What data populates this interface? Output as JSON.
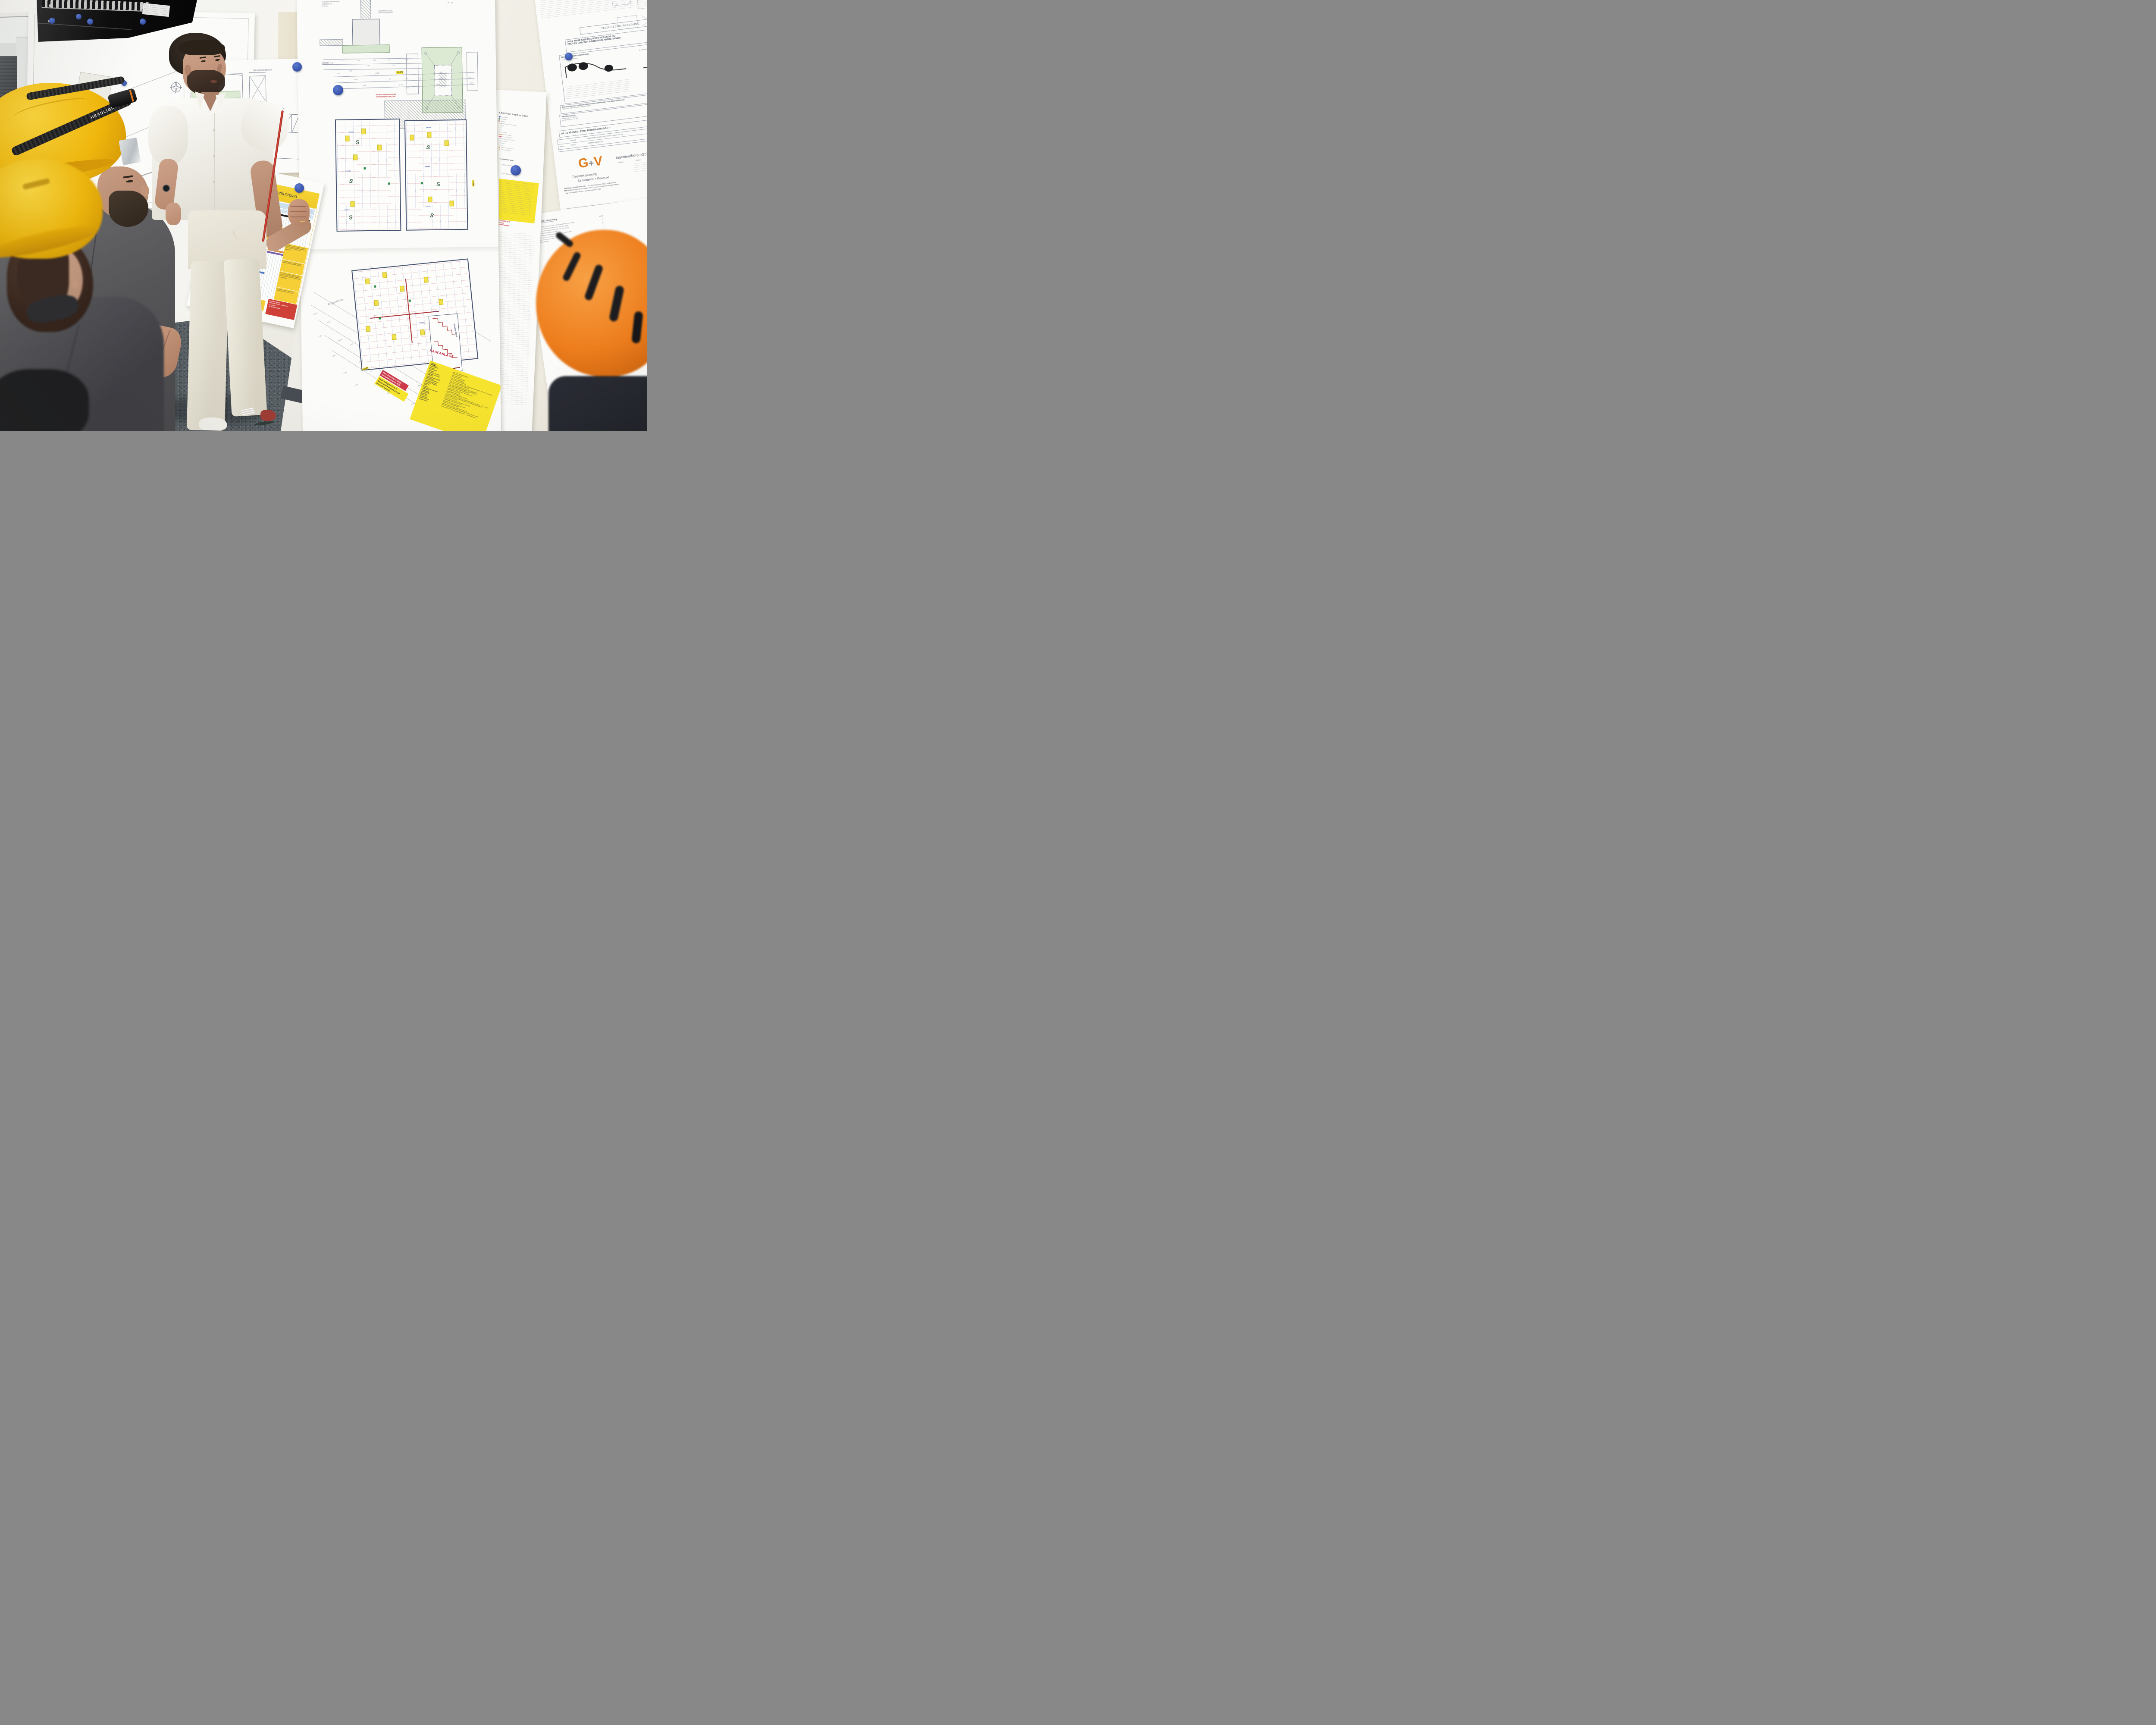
{
  "scene_description": "Construction team briefing in front of wall of pinned technical drawings",
  "people": {
    "left_helmet_strap_text": "HEADLIGHT"
  },
  "sheets": {
    "bridge": {
      "caption": "SCHNITT CONTAINERHALLE · BRÜCKE · BESTAND",
      "detail": "Querschnitt Brücke",
      "slope": "Dachneigung 2%"
    },
    "safety": {
      "title": "Sicherheits- und Gesundheitsschutzplan",
      "orange_note": [
        "Temporäre Abdeckungen:",
        "Öffnungen sind sofort nach der",
        "Erzeugung gegen Ein- oder",
        "Durchtreten zu sichern"
      ],
      "boxes": [
        "Vor Aufnahme der Tätigkeit erfolgt eine Erstunterweisung der Mitarbeiter durch die jeweiligen Führungskräfte (Bauleiter)",
        "Nur unterwiesenes und autorisiertes Personal darf die Baustelle betreten!",
        "Flucht- und Rettungswege sind immer zu gewährleisten; ggf. ist ein Änderung vor Ort abzustimmen und entsprechend zu beschildern!",
        "Der Bauzaun bzw. Baubereich ist jederzeit geschlossen zu halten"
      ],
      "red_notice": [
        "Unfälle / Notfälle",
        "sind dem SiGeKo umgehend",
        "zu melden!",
        "Tel. 0170 932 8006"
      ]
    },
    "center": {
      "found_titles": [
        "KÖCHERFUNDAMENT",
        "SCHALPLAN",
        "M. 1:25"
      ],
      "wall_note": [
        "KÖCHERWANDUNG",
        "GLATTE SCHALUNG"
      ],
      "scale_note": "M 1:25",
      "schnitt_label": "SCHNITT 1 - 1",
      "found_dims": [
        "1.18",
        "40",
        "1.10",
        "40",
        "1.18",
        "1.90",
        "4.20",
        "2.10"
      ],
      "access_note": [
        "ZUGANG OBERGESCHOSS",
        "SONDERKONSTRUKTION"
      ],
      "dim_highlight": "15.470",
      "dims_top": [
        "160",
        "15.150",
        "160",
        "6.060",
        "15",
        "2.000",
        "15",
        "6.060",
        "160",
        "6.465",
        "2.220",
        "2.800",
        "6.465",
        "1.39"
      ],
      "room_ids": [
        "3002419",
        "3002418",
        "3002417",
        "3002425",
        "3002426",
        "3002423"
      ],
      "dim_right": "10.684",
      "erdgeschoss_label": "Erdgeschoss",
      "stairs_note": "4 Stufen 29/15",
      "existing_note": "Bestandsgebäude",
      "dim_highlight2": "23.075",
      "dims_left": [
        "-23.075",
        "6.195",
        "6.060",
        "-20.045",
        "2.200",
        "2.350",
        "-17.007",
        "2.440",
        "15",
        "3.660",
        "-14.552",
        "3.000",
        "-11.537",
        "-8.522",
        "-6.067",
        "-3.030"
      ],
      "stair_ids": [
        "3001950",
        "3001951"
      ]
    },
    "legend": {
      "title": "LEGENDE ANSCHLÜSSE",
      "items": [
        {
          "shape": "circle",
          "color": "#2f56b0",
          "label": "Regenwasser"
        },
        {
          "shape": "diamond",
          "color": "#3d7a36",
          "label": "Trinkwasser"
        },
        {
          "shape": "diamond",
          "color": "#8a2f2f",
          "label": "Abwasser"
        },
        {
          "shape": "diamond",
          "color": "#d9a32a",
          "label": "Fäkalienhaltiges Schmutzwasser"
        },
        {
          "shape": "diamond",
          "color": "#c04a7a",
          "label": "Heizung"
        },
        {
          "shape": "square",
          "color": "#d97f2a",
          "label": "Gas"
        },
        {
          "shape": "square",
          "color": "#cc3127",
          "label": "Strom"
        },
        {
          "shape": "square",
          "color": "#f0d32f",
          "label": "Daten, Toiletten"
        },
        {
          "shape": "line",
          "color": "#e08a3c",
          "label": "Leerrohr Elektro"
        },
        {
          "shape": "line",
          "color": "#d84f8e",
          "label": "Leerrohre Heizung"
        },
        {
          "shape": "square",
          "color": "#aab4c0",
          "label": "Bodendurchbruch / Bodenablauf"
        },
        {
          "shape": "diamond",
          "color": "#7a9ac4",
          "label": "Deckendurchbruch"
        },
        {
          "shape": "circle",
          "color": "#9a6a5a",
          "label": "Schutzleitung"
        },
        {
          "shape": "circle",
          "color": "#a8a8a8",
          "label": "Tiefenerder"
        },
        {
          "shape": "bar",
          "color": "#e0a060",
          "label": "Ringerder V4A 30x3,5 mm"
        },
        {
          "shape": "bar",
          "color": "#e8c090",
          "label": "Graben für Ringerder"
        }
      ],
      "title2": "LEGENDE Fundamente Ideen",
      "fund_items": [
        {
          "color": "#f2d12e",
          "label": "1000x1000x200mm"
        },
        {
          "color": "#d33a2f",
          "label": "1200x1200x250mm"
        }
      ],
      "note_red": [
        "NEUE PROJEKTGRUNDLAGE",
        "Bodenbelag Variante 3",
        "komplett auf Baustelle gelegt!"
      ]
    },
    "titleblock": {
      "technical_change": "TECHNISCHE ÄNDERUNG",
      "mass_note": [
        "ALLE MAßE SIND BAUSEITS VERANTW. ZU",
        "PRÜFEN UND VOR BAUBEGINN ABZUSTIMMEN"
      ],
      "bend_title": "Biegen von Betonstahlmatten",
      "bend_a": "A) Biegungen zur Kröpfung",
      "bend_b": "B) einfache Biegungen",
      "classes_row": "Betonfestigkeits- und Expositionsklassen; Betonstahl- und Spannstahlsorte:",
      "classes_detail": "C25/30 WF, XC2, XF1 bzw. FUNDAMENTBAU",
      "cover_row": "Betondeckung:",
      "cover_details": [
        "Verlegemaß: cv = 35 mm",
        "Vorhaltemaß: Δc = 15 mm"
      ],
      "rohbau_note": "ALLE MASSE SIND ROHBAUMASSE !",
      "index_row": [
        "'A'",
        "24.08.25",
        "ÄNDERUNGEN NACH PRÜFSTATIK (zusätzl. Pos. 14)"
      ],
      "index_header": [
        "INDEX",
        "DATUM",
        "ART DER ÄNDERUNG"
      ],
      "logo": {
        "g": "G",
        "plus": "+",
        "v": "V",
        "firm": "Ingenieurbüro eGbR",
        "partner1": "Vielgut",
        "partner2": "Vielgut",
        "tagline1": "Tragwerksplanung",
        "tagline2": "für Industrie + Gewerbe"
      },
      "fields": [
        {
          "label": "AUFTRAG- GEBER",
          "value": "GMB GbR — Am Tannenberg 29 · 96132 Schlüsselfeld"
        },
        {
          "label": "PROJEKT:",
          "value": "Zukunftsvision Embeka / KB Container — Standort Langenlonsheim"
        },
        {
          "label": "TEIL:",
          "value": "FUNDAMENTPLAN — Köcherfundament -F1.1"
        },
        {
          "label": "ZEICHNUNGSNUMMER:",
          "value": "24649 - FU 1.5A"
        },
        {
          "label": "MASSTAB:",
          "value": "1 : 25"
        }
      ],
      "sig": [
        {
          "label": "GEZEICHNET:",
          "name": "TAUSCH",
          "date": "18.08.2025"
        },
        {
          "label": "GEÄNDERT:",
          "name": "TAUSCH",
          "date": "24.08.2025"
        },
        {
          "label": "GEÄNDERT:",
          "name": "",
          "date": ""
        }
      ],
      "footer": "G+V 24649"
    },
    "kauf": {
      "title": "KAUFANLAGE",
      "subtitle": "Farben:",
      "rows": [
        {
          "l": "Container:",
          "v": "RAL 7016  Rahmen&Panele"
        },
        {
          "l": "Sockelblende:",
          "v": "RAL 7016  außen"
        },
        {
          "l": "Fenster:",
          "v": "RAL 7016  innen"
        },
        {
          "l": "Fenster TPH:",
          "v": "RAL 9016  innen&außen"
        },
        {
          "l": "Alutüren:",
          "v": "RAL 7016  innen&außen"
        },
        {
          "l": "Türzargen Innentür:",
          "v": "Eiche, lasiert weiß (Klassen)"
        },
        {
          "l": "Türblätter Innentüren:",
          "v": "RAL 1016 Schwefelgelb / RAL 9006 Silbermetallic / RAL 9010 weiß (zwischen Klassen, Team zu Technik)"
        },
        {
          "l": "Raffstore:",
          "v": "Jeldwen Duritop Uni weiß beidseitig"
        },
        {
          "l": "Innwand Gipswand Q3:",
          "v": "RAL 1016 Schwefelgelb flurseitig + raumseitig weiß"
        },
        {
          "l": "Wandfliesen:",
          "v": "RAL 9006 Silbermetallic flurseitig + raumseitig weiß"
        },
        {
          "l": "Akustikabhangdecke:",
          "v": "Eiche, lasiert weiß beidseitig (Klassen)"
        },
        {
          "l": "Sanitärtrennwände:",
          "v": "Lamellen RAL 7016, 60 mm / Weiß RAL 9010"
        },
        {
          "l": "Beschläge/ Standard",
          "v": "Silbermetallic RAL 9006"
        },
        {
          "l": "Zubehör:",
          "v": "Schwefelgelb RAL 1016"
        },
        {
          "l": "Dach:",
          "v": "Kermos Concept Plato, weiß, 10x10 cm"
        },
        {
          "l": "Vordach:",
          "v": "Knauf HERADESIGN Superfine, Beige (Plattengröße 60x120cm - GK, verschraubt im halbversatz)"
        },
        {
          "l": "Dämmung Sekundärdach:",
          "v": "CTH 13-2 HPL 0085 FH Weiß, H:2000 mm, mit Fingerklemmschutz"
        },
        {
          "l": "Attikablech",
          "v": "ECO 07 (ca. RAL 1021)"
        },
        {
          "l": "Bodenbelag:",
          "v": "Trapezblech RAL 9002 / Trapezblech RAL 7016"
        },
        {
          "l": "Linoleum R9:",
          "v": "Mineralwolle 100mm / RAL 7016"
        },
        {
          "l": "Nadelvlies:",
          "v": "marmoleum cocoa, 3584 white chocolate"
        },
        {
          "l": "Fliesen R10:",
          "v": "Nadelvlies Forbo 96003 sand"
        },
        {
          "l": "Sockelleiste:",
          "v": "vilbostoneplus 10x10cm, anthrazit: PN83, R10"
        },
        {
          "l": "Sauberlaufzone:",
          "v": "bei Lino Hochzug Bodenbelag, Sockelleiste, Vollholz, Buche - weiß"
        },
        {
          "l": "Treppenstufen:",
          "v": "2,00x1,80m, 080 Sand, Gorips / Nadelvlies - Euval 93.00 Bono"
        }
      ]
    },
    "announce": {
      "red": [
        "Neue Projektgrundlage",
        "Containervariante 2025"
      ],
      "yellow": [
        "Bodenbelagsvariante 3",
        "Boden wird komplett auf der",
        "Baustelle verlegt!"
      ]
    },
    "elt": {
      "title": "L 03 Legende-ELT Beleuchtung",
      "col1": "Element ID",
      "col2": "Menge",
      "rows": [
        {
          "t": "Tafelbeleuchtung TRILUX, Atrion D-L RAV 1500 4900-840 ET, 38W (TOC 77x1240)",
          "q": "12"
        },
        {
          "t": "TRILUX, Atrion D-L RPV 1200 3300-840-ET, 31W, LED, TOC 6492840",
          "q": "22"
        },
        {
          "t": "TRILUX, Atrion D-L RPV 1500 3200-840 ET, 52W, LED, TOC 6634640",
          "q": "50"
        },
        {
          "t": "LEDVANCE FLOODLIGHT SENSOR 50 41W",
          "q": "2"
        },
        {
          "t": "Feuchtraumwannenleuchte Adolf Schuch GmbH 167  G2_LED 43W 5200lm",
          "q": "4"
        },
        {
          "t": "Präsenzmelder ESYLUX Basic Einbau",
          "q": ""
        },
        {
          "t": "Präsenzmelder ESYLUX Basic Aufputz",
          "q": ""
        },
        {
          "t": "Präsenzmelder HF-Melder",
          "q": ""
        }
      ],
      "kb_logo": "KB",
      "kb_sub": "KB Container GmbH"
    }
  }
}
